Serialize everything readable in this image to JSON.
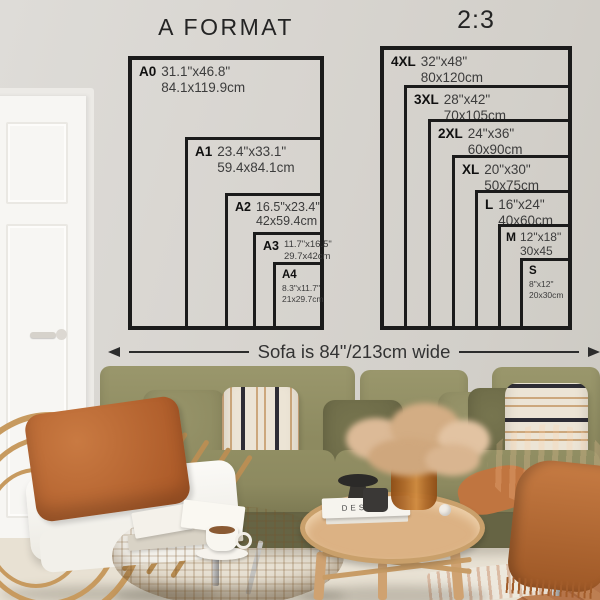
{
  "wall_art": {
    "a_format": {
      "title": "A FORMAT",
      "sizes": [
        {
          "label": "A0",
          "inches": "31.1\"x46.8\"",
          "cm": "84.1x119.9cm"
        },
        {
          "label": "A1",
          "inches": "23.4\"x33.1\"",
          "cm": "59.4x84.1cm"
        },
        {
          "label": "A2",
          "inches": "16.5\"x23.4\"",
          "cm": "42x59.4cm"
        },
        {
          "label": "A3",
          "inches": "11.7\"x16.5\"",
          "cm": "29.7x42cm"
        },
        {
          "label": "A4",
          "inches": "8.3\"x11.7\"",
          "cm": "21x29.7cm"
        }
      ]
    },
    "ratio_2_3": {
      "title": "2:3",
      "sizes": [
        {
          "label": "4XL",
          "inches": "32\"x48\"",
          "cm": "80x120cm"
        },
        {
          "label": "3XL",
          "inches": "28\"x42\"",
          "cm": "70x105cm"
        },
        {
          "label": "2XL",
          "inches": "24\"x36\"",
          "cm": "60x90cm"
        },
        {
          "label": "XL",
          "inches": "20\"x30\"",
          "cm": "50x75cm"
        },
        {
          "label": "L",
          "inches": "16\"x24\"",
          "cm": "40x60cm"
        },
        {
          "label": "M",
          "inches": "12\"x18\"",
          "cm": "30x45"
        },
        {
          "label": "S",
          "inches": "8\"x12\"",
          "cm": "20x30cm"
        }
      ]
    },
    "sofa_width_note": "Sofa is 84\"/213cm wide"
  },
  "scene": {
    "book_spine": "DESIGN",
    "colors": {
      "line": "#1b1b1b",
      "wall": "#d8d5d0",
      "door": "#f7f6f3",
      "sofa": "#8d8a60",
      "sofa-deep": "#666444",
      "cream": "#ece4d5",
      "stripe-black": "#2e2d35",
      "stripe-tan": "#c2935e",
      "rust": "#bc6f37",
      "rust-deep": "#9e5826",
      "rattan": "#c79a5f",
      "wood": "#dcb284",
      "wood-rim": "#c9a06b",
      "floor": "#e8e1d3",
      "wood-floor": "#b5744a",
      "amber": "#b06a28"
    }
  }
}
